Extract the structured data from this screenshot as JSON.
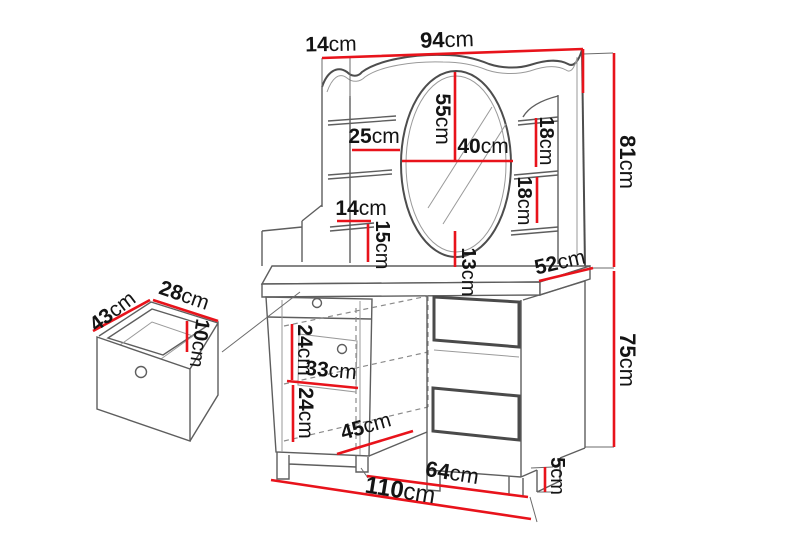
{
  "diagram": {
    "type": "furniture-dimension-drawing",
    "subject": "dressing table with mirror, shelves and pull-out drawer",
    "colors": {
      "dimension_red": "#e8131b",
      "outline_gray": "#5e5e5e",
      "label_black": "#141414",
      "background": "#ffffff"
    },
    "dims": [
      {
        "id": "top-depth",
        "value": "14",
        "unit": "cm"
      },
      {
        "id": "top-width",
        "value": "94",
        "unit": "cm"
      },
      {
        "id": "superstructure-height",
        "value": "81",
        "unit": "cm"
      },
      {
        "id": "left-shelf-width",
        "value": "25",
        "unit": "cm"
      },
      {
        "id": "mirror-height",
        "value": "55",
        "unit": "cm"
      },
      {
        "id": "mirror-width",
        "value": "40",
        "unit": "cm"
      },
      {
        "id": "right-shelf-gap-upper",
        "value": "18",
        "unit": "cm"
      },
      {
        "id": "right-shelf-gap-lower",
        "value": "18",
        "unit": "cm"
      },
      {
        "id": "lower-shelf-width",
        "value": "14",
        "unit": "cm"
      },
      {
        "id": "lower-shelf-height",
        "value": "15",
        "unit": "cm"
      },
      {
        "id": "mirror-to-tabletop",
        "value": "13",
        "unit": "cm"
      },
      {
        "id": "tabletop-depth",
        "value": "52",
        "unit": "cm"
      },
      {
        "id": "table-height",
        "value": "75",
        "unit": "cm"
      },
      {
        "id": "drawer-depth",
        "value": "43",
        "unit": "cm"
      },
      {
        "id": "drawer-width",
        "value": "28",
        "unit": "cm"
      },
      {
        "id": "drawer-height",
        "value": "10",
        "unit": "cm"
      },
      {
        "id": "cabinet-upper-section",
        "value": "24",
        "unit": "cm"
      },
      {
        "id": "cabinet-inner-width",
        "value": "33",
        "unit": "cm"
      },
      {
        "id": "cabinet-lower-section",
        "value": "24",
        "unit": "cm"
      },
      {
        "id": "cabinet-depth",
        "value": "45",
        "unit": "cm"
      },
      {
        "id": "kneespace-width",
        "value": "64",
        "unit": "cm"
      },
      {
        "id": "plinth-height",
        "value": "5",
        "unit": "cm"
      },
      {
        "id": "total-width",
        "value": "110",
        "unit": "cm"
      }
    ]
  }
}
